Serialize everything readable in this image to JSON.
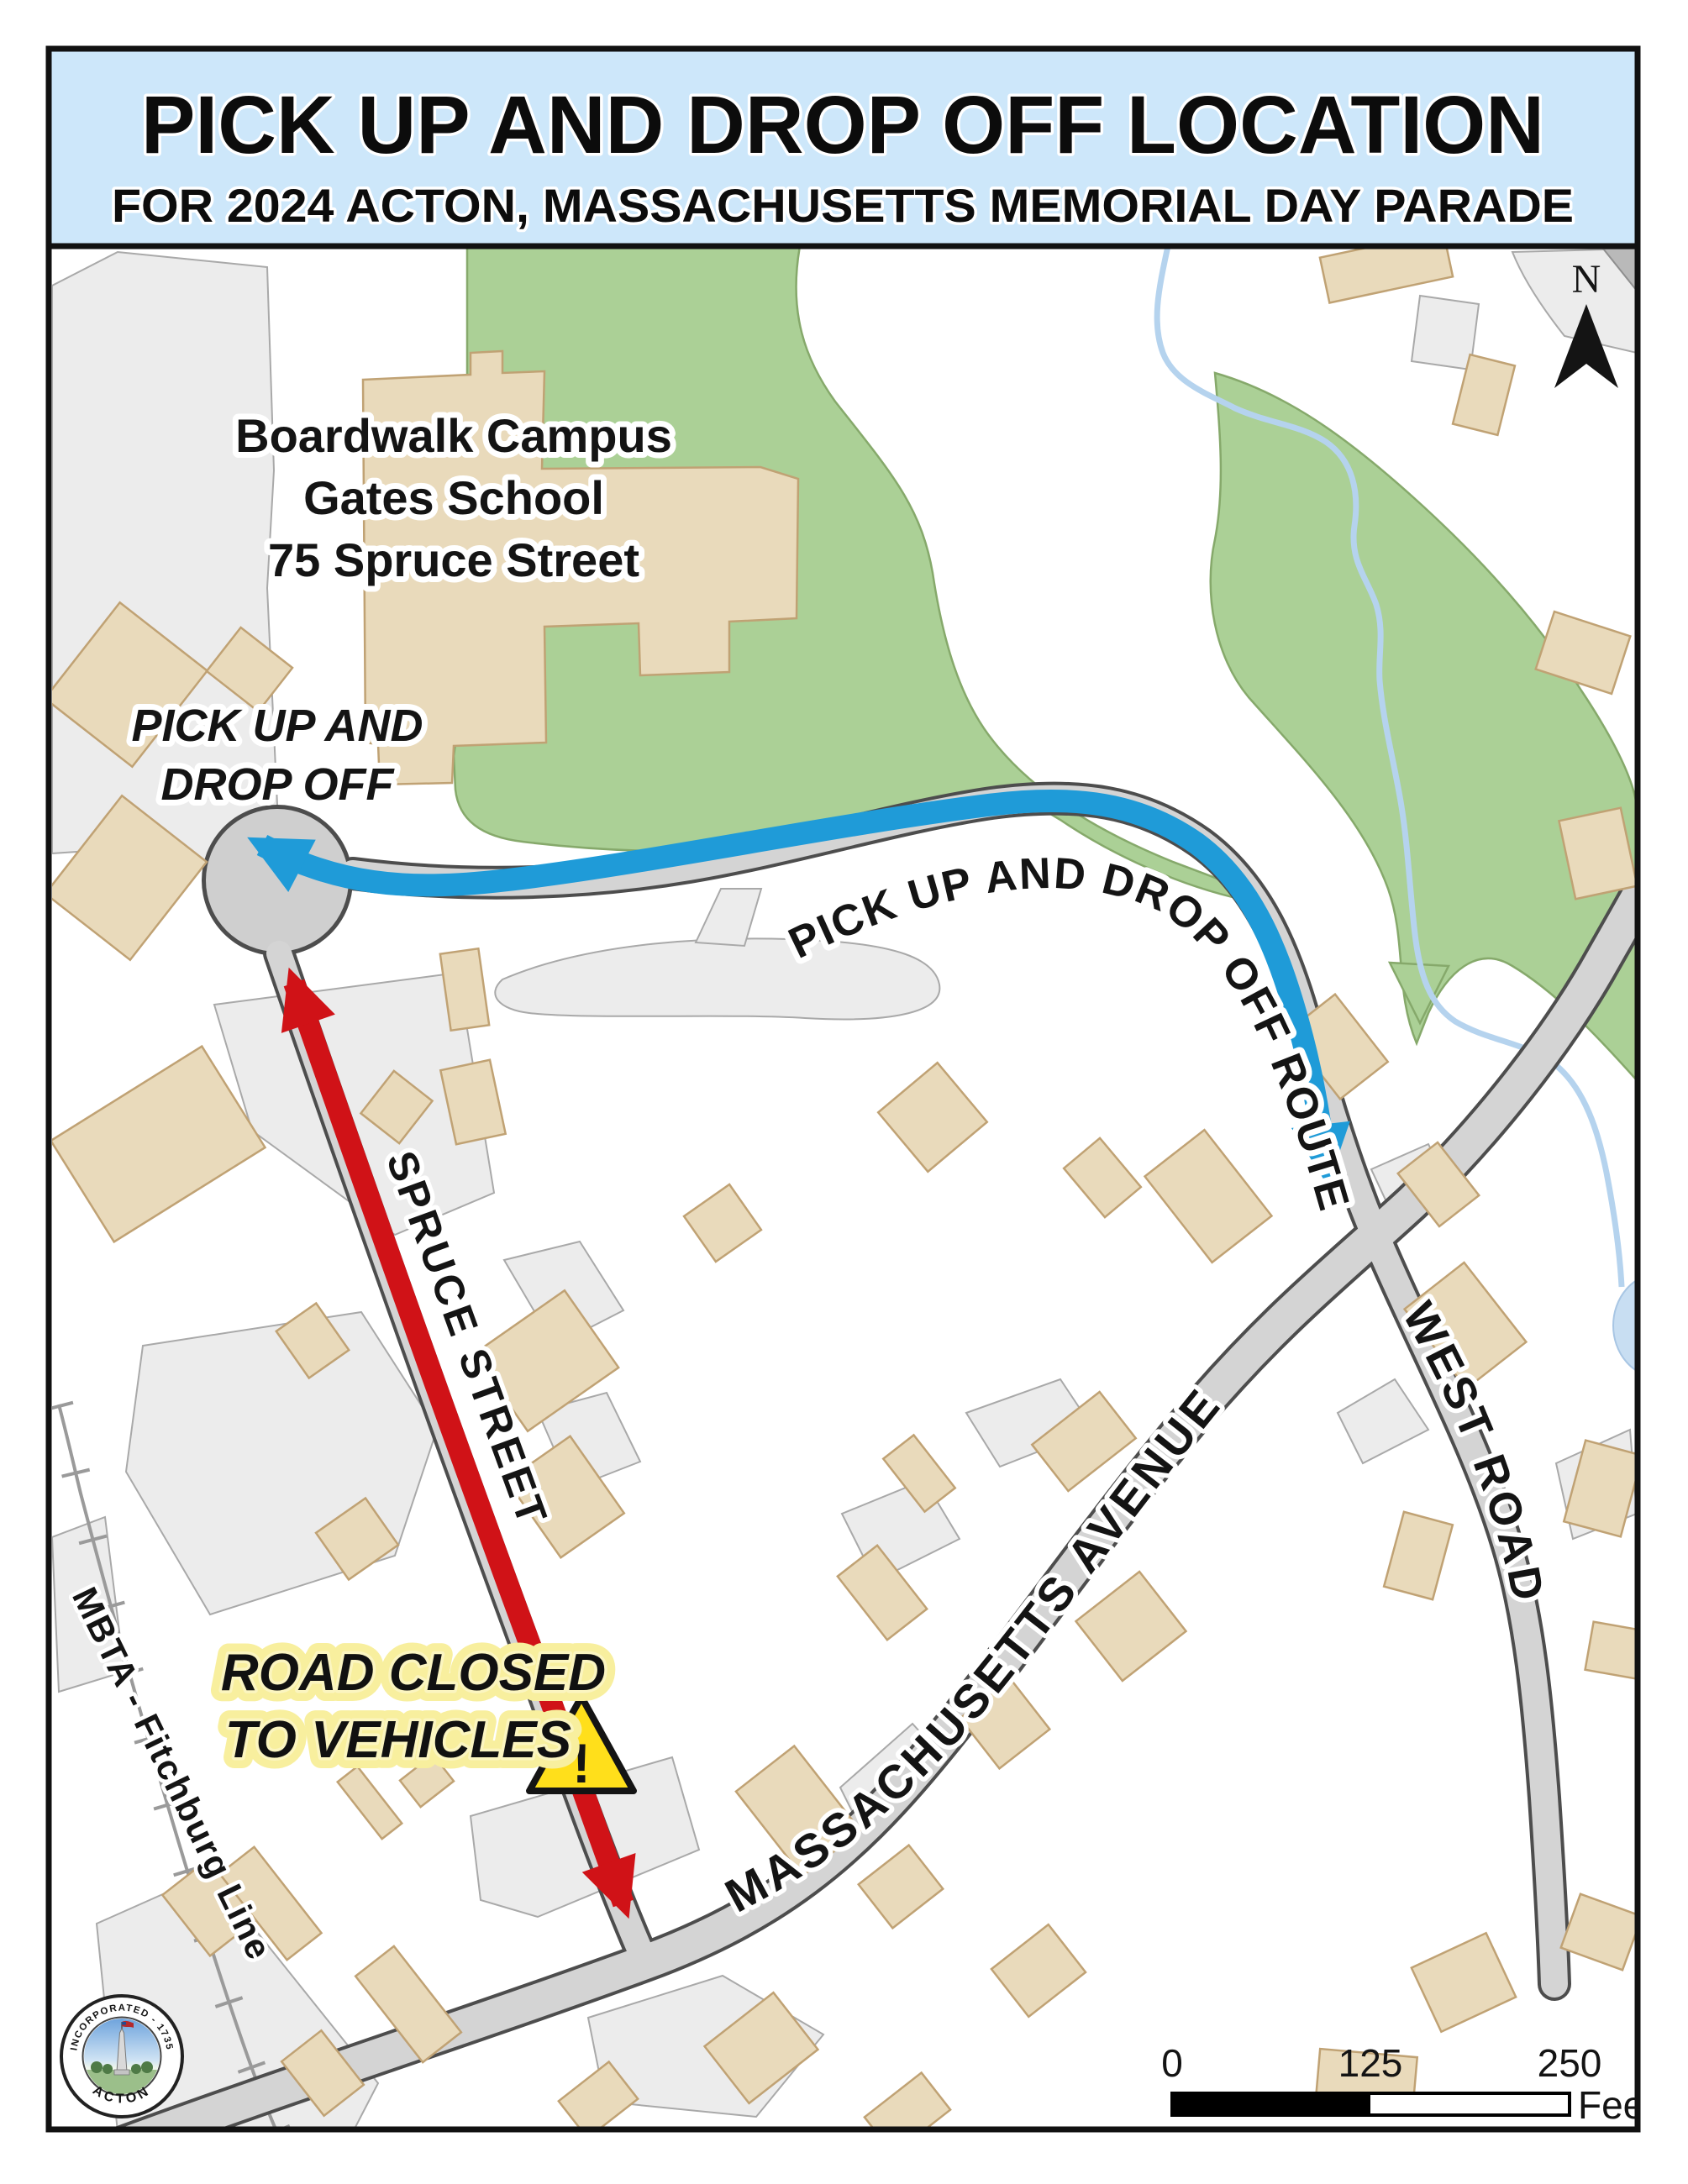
{
  "title": {
    "line1": "PICK UP AND DROP OFF LOCATION",
    "line2": "FOR 2024 ACTON, MASSACHUSETTS MEMORIAL DAY PARADE"
  },
  "map": {
    "school_label": {
      "line1": "Boardwalk Campus",
      "line2": "Gates School",
      "line3": "75 Spruce Street"
    },
    "pickup_label": {
      "line1": "PICK UP AND",
      "line2": "DROP OFF"
    },
    "route_label": "PICK UP AND DROP OFF ROUTE",
    "road_closed": {
      "line1": "ROAD CLOSED",
      "line2": "TO VEHICLES",
      "warning_symbol": "!"
    },
    "streets": {
      "spruce": "SPRUCE STREET",
      "mass_ave": "MASSACHUSETTS AVENUE",
      "west_road": "WEST ROAD",
      "railroad": "MBTA - Fitchburg Line"
    },
    "north_label": "N"
  },
  "scale_bar": {
    "start": "0",
    "mid": "125",
    "end": "250",
    "unit": "Feet"
  },
  "seal": {
    "top_text": "INCORPORATED - 1735",
    "bottom_text": "ACTON"
  },
  "colors": {
    "banner_blue": "#cde7fa",
    "frame_black": "#111111",
    "woods_green": "#abd096",
    "building_tan": "#e9dabb",
    "pavement_gray": "#ececec",
    "road_gray": "#d4d4d4",
    "route_blue": "#1f9bd8",
    "closed_red": "#d01217",
    "warning_yellow": "#ffdf1b",
    "stream_blue": "#b5d3ee"
  }
}
